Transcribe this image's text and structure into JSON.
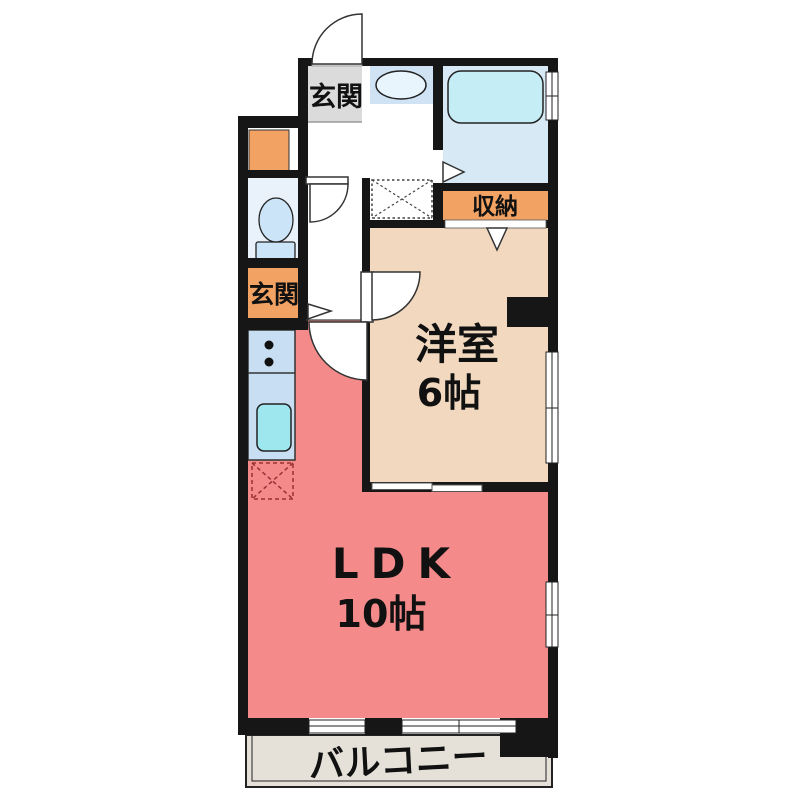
{
  "plan": {
    "type": "apartment-floor-plan",
    "rooms": {
      "entrance_top": {
        "label": "玄関"
      },
      "entrance_side": {
        "label": "玄関"
      },
      "closet": {
        "label": "収納"
      },
      "western_room": {
        "label": "洋室",
        "size": "6帖"
      },
      "ldk": {
        "label": "LDK",
        "size": "10帖"
      },
      "balcony": {
        "label": "バルコニー"
      }
    },
    "colors": {
      "wall": "#161616",
      "entrance_gray": "#DBDBDB",
      "orange": "#F2A263",
      "white": "#FFFFFF",
      "toilet_room": "#E9F1FA",
      "fixture_blue": "#CCE4F7",
      "bathroom": "#D8E9F6",
      "bathtub": "#C5EDF6",
      "basin_band": "#CFE3F4",
      "basin": "#E8F5FC",
      "western_room": "#F1D8BE",
      "ldk": "#F58A8A",
      "counter": "#C8DEF2",
      "sink": "#9FE7EF",
      "balcony": "#E5E1D9",
      "fridge_dash": "#993333",
      "text": "#111111"
    }
  }
}
